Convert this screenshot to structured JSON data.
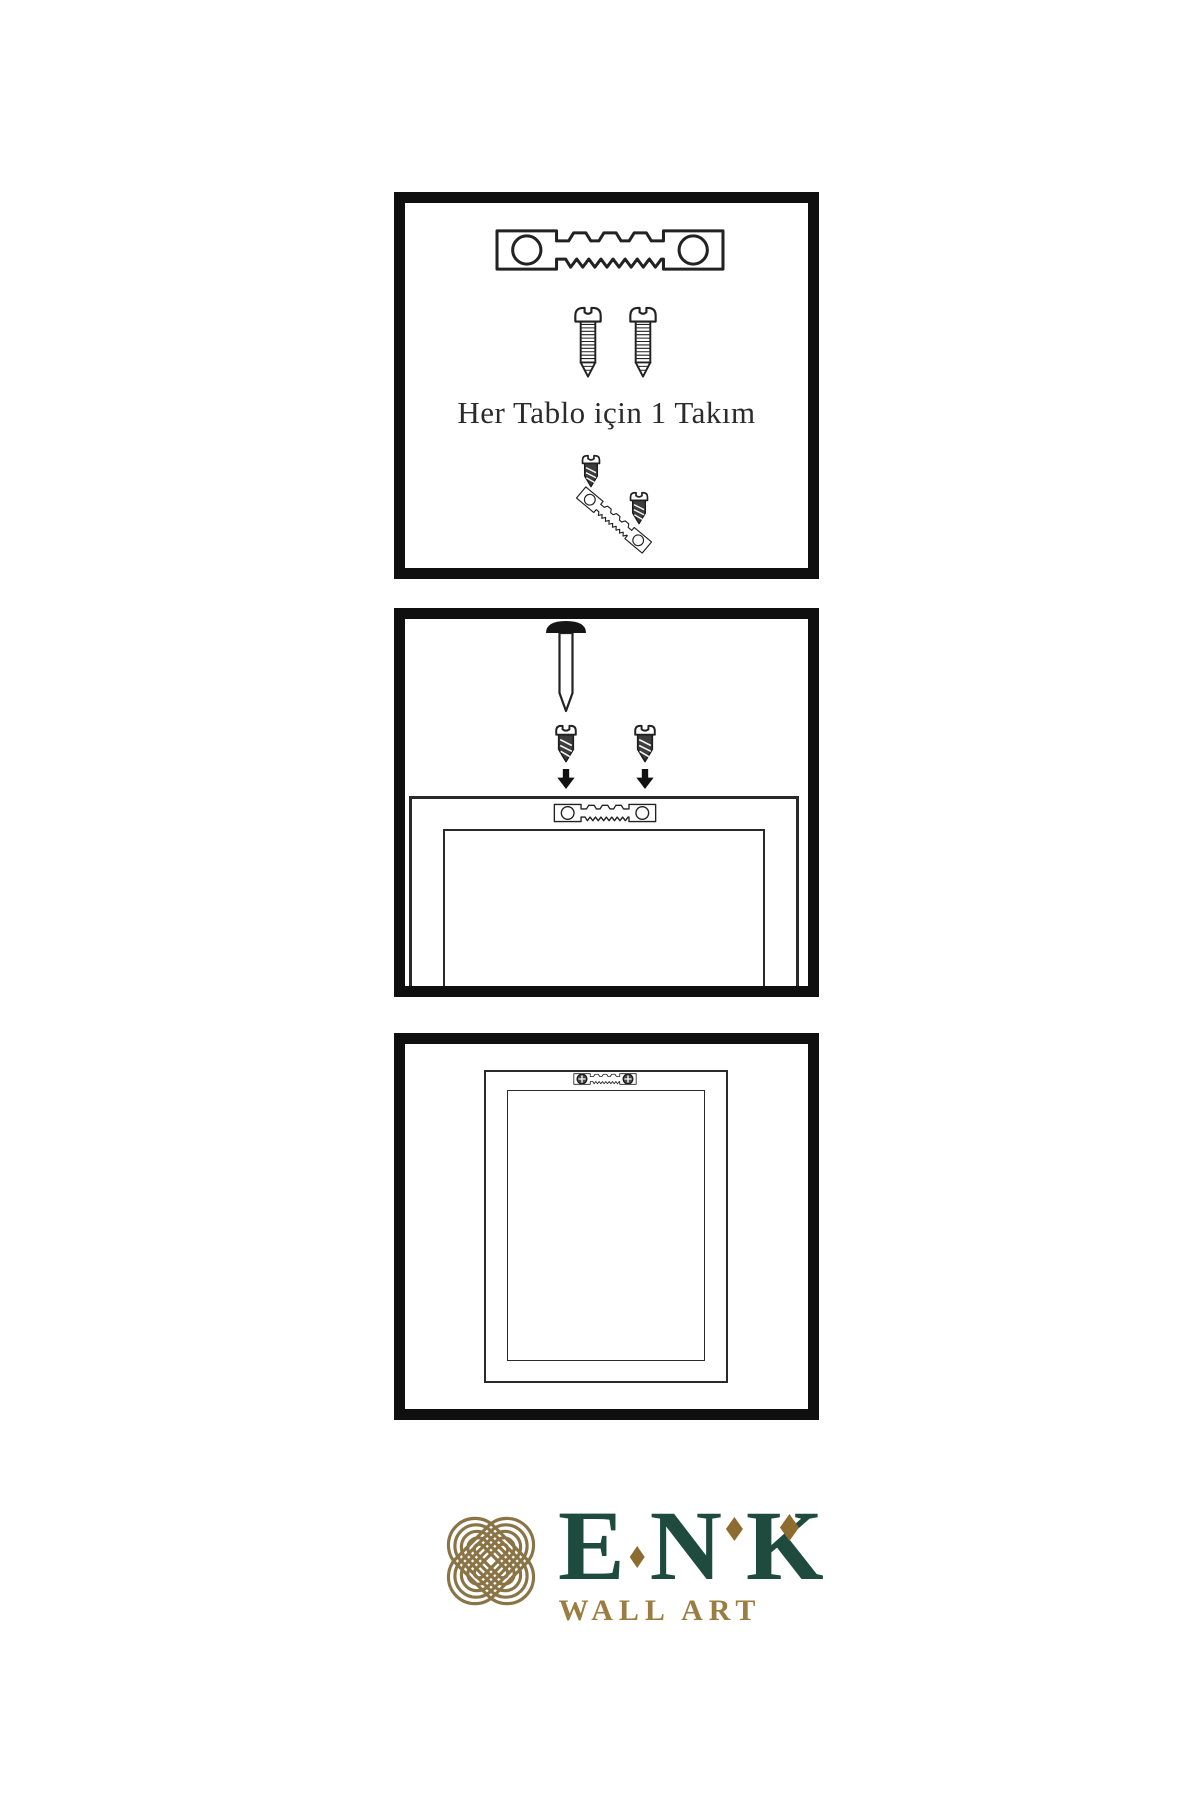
{
  "page": {
    "background_color": "#ffffff"
  },
  "instructions": {
    "step1": {
      "name": "hardware-set",
      "caption": "Her Tablo için 1 Takım",
      "icons": [
        "sawtooth-hanger-icon",
        "screw-icon",
        "screw-icon",
        "dark-screw-icon",
        "tilted-sawtooth-hanger-icon",
        "dark-screw-icon"
      ]
    },
    "step2": {
      "name": "attach-hanger-and-wall-nail",
      "icons": [
        "wall-nail-icon",
        "dark-screw-icon",
        "down-arrow-icon",
        "dark-screw-icon",
        "down-arrow-icon",
        "frame-back-icon",
        "sawtooth-hanger-icon"
      ]
    },
    "step3": {
      "name": "mounted-frame",
      "icons": [
        "frame-back-icon",
        "sawtooth-hanger-icon",
        "phillips-screw-icon",
        "phillips-screw-icon"
      ]
    }
  },
  "logo": {
    "brand_letters": [
      "E",
      "N",
      "K"
    ],
    "subtitle": "WALL ART",
    "knot_icon": "interlocked-knot-icon",
    "colors": {
      "letters_green": "#1e4b3d",
      "knot_gold": "#8a7446",
      "diamond_gold": "#8e6c30",
      "subtitle_gold": "#9b7c41"
    }
  },
  "artwork": {
    "line_color": "#222222",
    "panel_border_color": "#0f0f0f"
  }
}
